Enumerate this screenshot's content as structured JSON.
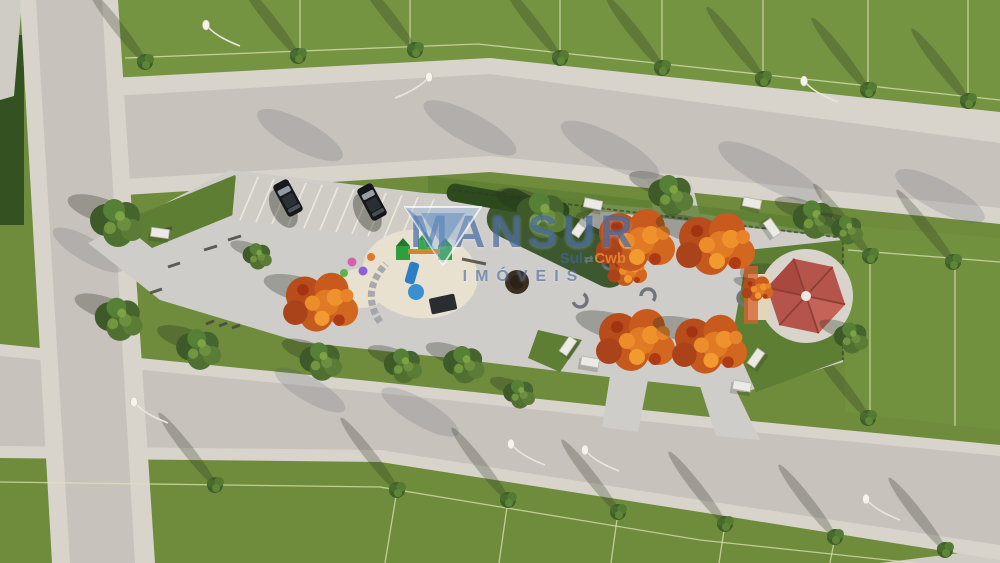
{
  "watermark": {
    "brand": "MANSUR",
    "sub_left": "Sul",
    "sub_divider": "⇄",
    "sub_right": "Cwb",
    "tagline": "IMÓVEIS"
  },
  "colors": {
    "grass": "#6e8c3c",
    "grassLight": "#7a9a45",
    "parkLawn": "#5e7e33",
    "hedge": "#2c4a1e",
    "road": "#c7c2bb",
    "sidewalk": "#d8d4cb",
    "lotLine": "#dde3b4",
    "paving": "#cfcdca",
    "sand": "#e8e1d0",
    "treeGreen": "#4a6b2e",
    "treeOrange": "#d2671f",
    "gazeboRoof": "#b5544a",
    "carBlack": "#17191c",
    "watermarkBlue": "#3e64a0",
    "watermarkOrange": "#e8862d"
  },
  "scene": {
    "type": "aerial-3d-render",
    "elements": [
      "road-grid",
      "residential-lots",
      "lot-boundary-lines",
      "linear-park",
      "angled-parking-with-cars",
      "playground",
      "sand-pit",
      "exercise-stations",
      "autumn-trees",
      "green-trees",
      "street-trees",
      "curved-benches",
      "picnic-tables",
      "hexagonal-gazebo",
      "street-lamps",
      "hedge-beds"
    ]
  }
}
